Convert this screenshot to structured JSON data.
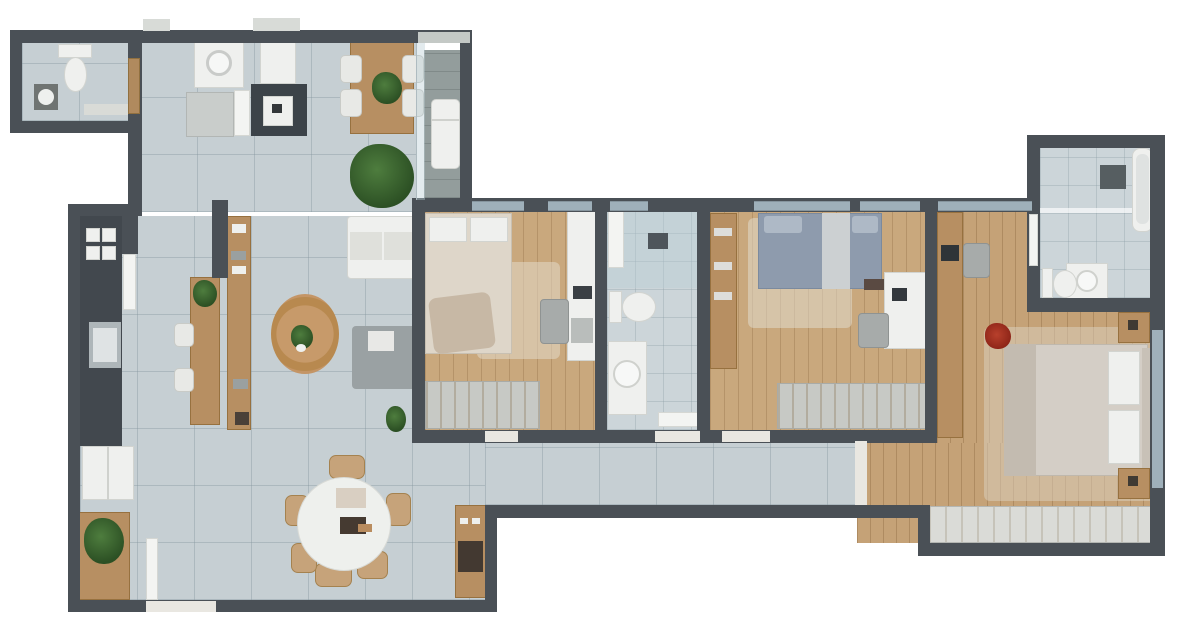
{
  "meta": {
    "kind": "3d-rendered-apartment-floor-plan-top-view",
    "canvas": {
      "width": 1200,
      "height": 636
    },
    "text_on_image": "none"
  },
  "palette": {
    "background": "#ffffff",
    "wall": "#4a5056",
    "tile_floor": "#c6cfd3",
    "bath_tile_floor": "#ccd5d9",
    "wood_floor": "#c9a87d",
    "balcony_floor": "#939d9c",
    "furniture_wood": "#b78f62",
    "white_fixture": "#eff0ee",
    "counter_dark": "#3c4349",
    "bed_blue": "#8e9bad",
    "bed_beige": "#ded6c9",
    "rug_beige": "#e2d8c8",
    "plant_green": "#2c5024",
    "flower_red": "#a83524",
    "window_glass": "#9fb0ba"
  },
  "rooms": [
    {
      "name": "guest bathroom (top-left)",
      "floor": "tile",
      "furniture": [
        "toilet",
        "washbasin",
        "shelf",
        "wood door"
      ]
    },
    {
      "name": "laundry / service area",
      "floor": "tile",
      "furniture": [
        "washing machine",
        "dryer",
        "dark cabinet with appliance",
        "counter",
        "open white door"
      ]
    },
    {
      "name": "breakfast nook",
      "floor": "tile",
      "furniture": [
        "wood table",
        "4 white chairs",
        "table plant",
        "large floor plant"
      ]
    },
    {
      "name": "balcony",
      "floor": "gray decking",
      "furniture": [
        "white lounger",
        "glass partition"
      ]
    },
    {
      "name": "kitchen",
      "floor": "tile",
      "furniture": [
        "dark L-counter",
        "cooktop",
        "sink",
        "fridge",
        "wood sideboard with plant",
        "bar island with plant",
        "2 white stools",
        "long wood counter with dishes"
      ]
    },
    {
      "name": "living room",
      "floor": "tile",
      "furniture": [
        "white sofa",
        "gray lounge seat",
        "round jute rug",
        "potted plant on rug",
        "corner plant"
      ]
    },
    {
      "name": "dining area",
      "floor": "tile",
      "furniture": [
        "round white table",
        "6 wood chairs",
        "placemat",
        "centerpiece",
        "coffee console with espresso machine",
        "entry door"
      ]
    },
    {
      "name": "bedroom 1",
      "floor": "wood",
      "furniture": [
        "double bed with messy blanket",
        "area rug",
        "white desk/dresser",
        "chair",
        "laptop",
        "striped wardrobe"
      ]
    },
    {
      "name": "hall bathroom",
      "floor": "bath tile",
      "furniture": [
        "shower zone with glass",
        "shower head",
        "toilet",
        "white vanity with sink",
        "open door"
      ]
    },
    {
      "name": "bedroom 2",
      "floor": "wood",
      "furniture": [
        "double bed blue-gray",
        "area rug",
        "white desk with monitor",
        "chair",
        "bench",
        "striped wardrobe",
        "tall wood closet"
      ]
    },
    {
      "name": "corridor",
      "floor": "tile",
      "furniture": [
        "threshold to master suite"
      ]
    },
    {
      "name": "master bedroom",
      "floor": "wood",
      "furniture": [
        "king bed with white pillows",
        "2 wood nightstands",
        "area rug",
        "red flower plant",
        "long wood console with TV",
        "chair",
        "striped wardrobe"
      ]
    },
    {
      "name": "ensuite bathroom",
      "floor": "bath tile",
      "furniture": [
        "bathtub",
        "vanity with sink",
        "toilet",
        "dark bath mat",
        "glass shower divider",
        "white door"
      ]
    }
  ]
}
